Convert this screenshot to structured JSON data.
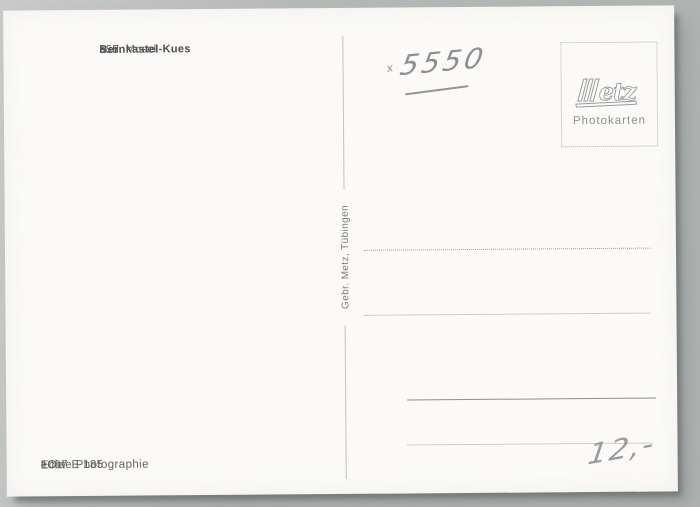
{
  "postcard": {
    "header": {
      "code": "555",
      "title": "Bernkastel-Kues",
      "subtitle": "a. d. Mosel"
    },
    "handwriting": {
      "mark": "x",
      "number": "5550",
      "price": "12,-"
    },
    "stamp_box": {
      "logo": "Metz",
      "logo_suffix": "etz",
      "label": "Photokarten"
    },
    "spine": {
      "publisher": "Gebr. Metz, Tübingen"
    },
    "footer": {
      "code": "1007 E 185",
      "label": "Echte Photographie",
      "suffix": "eOe"
    },
    "colors": {
      "background": "#b6b9b8",
      "card": "#fbfaf8",
      "print_ink": "#5c5c5c",
      "pencil": "#939393",
      "line": "#9f9f9f"
    }
  }
}
